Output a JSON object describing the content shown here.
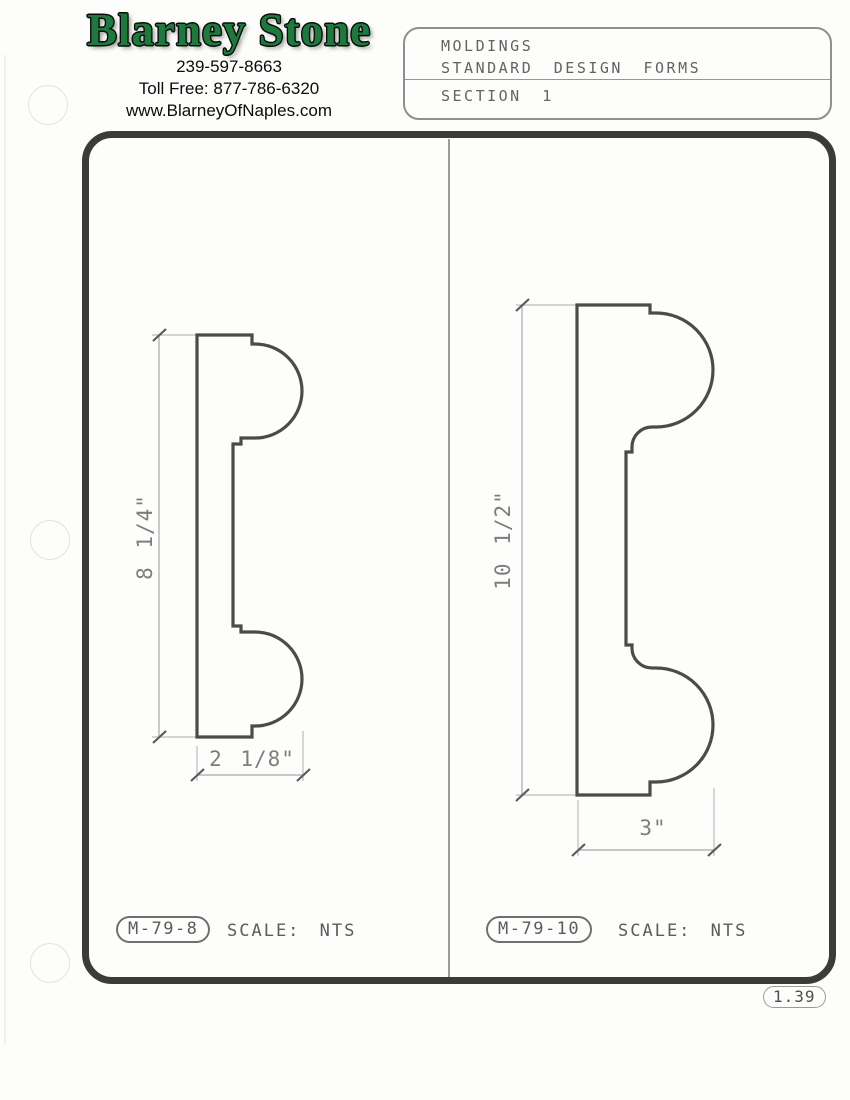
{
  "company": {
    "name": "Blarney Stone",
    "phone": "239-597-8663",
    "toll_free": "Toll Free: 877-786-6320",
    "website": "www.BlarneyOfNaples.com"
  },
  "title_block": {
    "line1": "MOLDINGS",
    "line2": "STANDARD DESIGN FORMS",
    "section": "SECTION 1"
  },
  "drawings": [
    {
      "id": "M-79-8",
      "scale_label": "SCALE: NTS",
      "height_dim": "8 1/4\"",
      "width_dim": "2 1/8\""
    },
    {
      "id": "M-79-10",
      "scale_label": "SCALE: NTS",
      "height_dim": "10 1/2\"",
      "width_dim": "3\""
    }
  ],
  "page_number": "1.39",
  "colors": {
    "logo_green": "#1e7a3c",
    "frame_dark": "#3d3b38",
    "profile_line": "#4d4b49",
    "dimension_gray": "#a0a0a0"
  }
}
